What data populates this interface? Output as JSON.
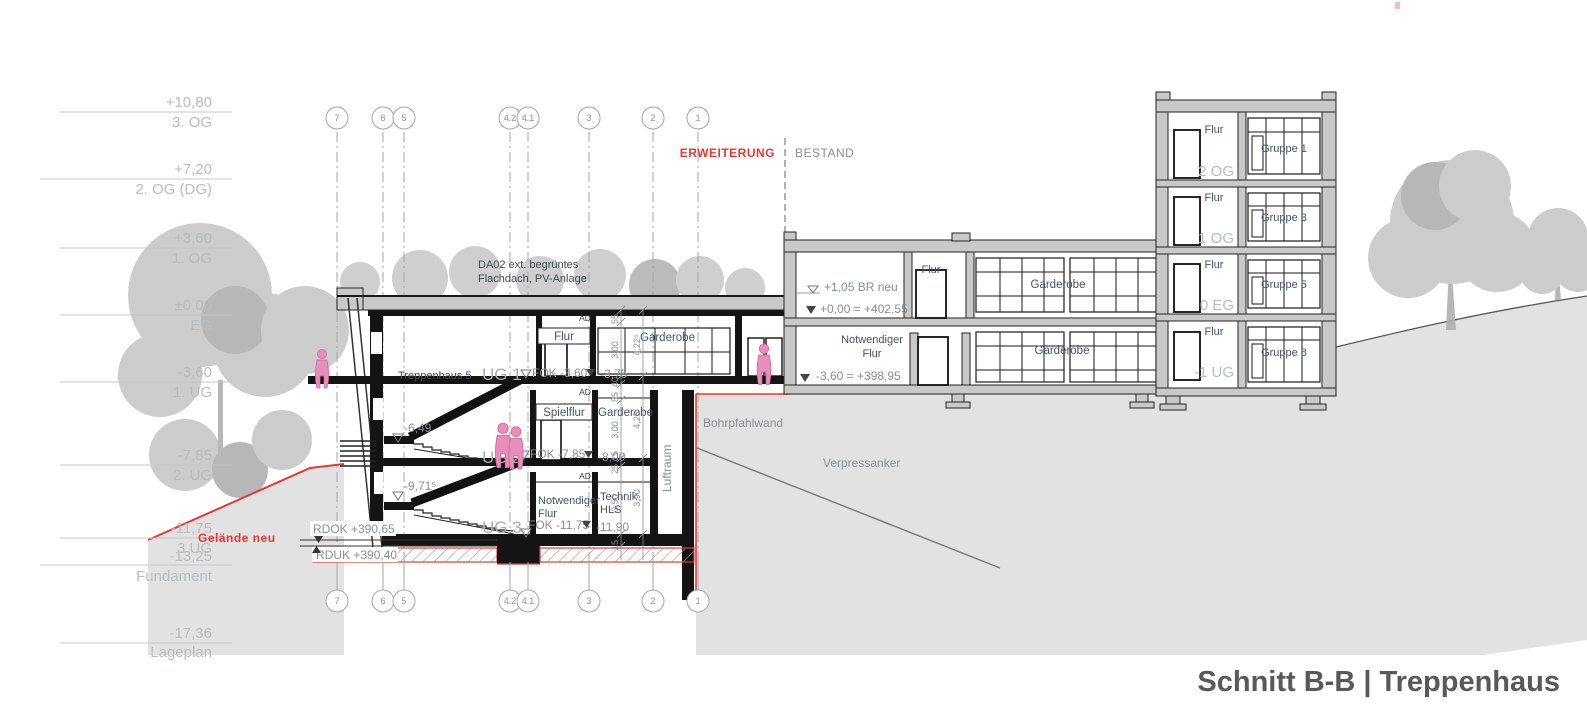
{
  "title": "Schnitt B-B | Treppenhaus",
  "zones": {
    "extension": "ERWEITERUNG",
    "existing": "BESTAND"
  },
  "elevation_scale": [
    {
      "value": "+10,80",
      "name": "3. OG"
    },
    {
      "value": "+7,20",
      "name": "2. OG (DG)"
    },
    {
      "value": "+3,60",
      "name": "1. OG"
    },
    {
      "value": "±0,00",
      "name": "EG"
    },
    {
      "value": "-3,60",
      "name": "1. UG"
    },
    {
      "value": "-7,85",
      "name": "2. UG"
    },
    {
      "value": "-11,75",
      "name": "3 UG"
    },
    {
      "value": "-13,25",
      "name": "Fundament"
    },
    {
      "value": "-17,36",
      "name": "Lageplan"
    }
  ],
  "grid_labels": [
    "7",
    "6",
    "5",
    "4.2",
    "4.1",
    "3",
    "2",
    "1"
  ],
  "extension": {
    "roof_note_l1": "DA02 ext. begrüntes",
    "roof_note_l2": "Flachdach, PV-Anlage",
    "stair_name": "Treppenhaus 5",
    "levels": [
      {
        "name": "UG 1",
        "fok": "FOK -3,60",
        "aux": "-3,75"
      },
      {
        "name": "UG 2",
        "fok": "FOK -7,85",
        "aux": "-8,00"
      },
      {
        "name": "UG 3",
        "fok": "FOK -11,75",
        "aux": "-11,90"
      }
    ],
    "mid_levels": {
      "upper": "-6,49",
      "lower": "-9,71⁵"
    },
    "rooms": {
      "ad": "AD",
      "flur": "Flur",
      "garderobe_eg": "Garderobe",
      "spielflur": "Spielflur",
      "garderobe_ug2": "Garderobe",
      "notflur_l1": "Notwendiger",
      "notflur_l2": "Flur",
      "technik_l1": "Technik",
      "technik_l2": "HLS",
      "luftraum": "Luftraum"
    },
    "dims_inner": [
      "55",
      "3,00",
      "40",
      "85",
      "3,00",
      "15",
      "25",
      "3,50",
      "15"
    ],
    "dims_outer": [
      "4,22⁵",
      "4,25",
      "3,90"
    ],
    "foundation": {
      "rdok": "RDOK +390,65",
      "rduk": "RDUK +390,40"
    },
    "ground_label": "Gelände neu",
    "bohrpfahlwand": "Bohrpfahlwand",
    "verpressanker": "Verpressanker"
  },
  "existing": {
    "levels": {
      "br": "+1,05 BR neu",
      "zero": "+0,00 = +402,55",
      "minus": "-3,60 = +398,95"
    },
    "rooms": {
      "flur": "Flur",
      "notflur_l1": "Notwendiger",
      "notflur_l2": "Flur",
      "garderobe_eg": "Garderobe",
      "garderobe_ug": "Garderobe"
    },
    "tower_floors": [
      {
        "room": "Flur",
        "group": "Gruppe 1",
        "level": "2 OG"
      },
      {
        "room": "Flur",
        "group": "Gruppe 3",
        "level": "1 OG"
      },
      {
        "room": "Flur",
        "group": "Gruppe 5",
        "level": "0 EG"
      },
      {
        "room": "Flur",
        "group": "Gruppe 8",
        "level": "-1 UG"
      }
    ]
  },
  "colors": {
    "red": "#e23b32",
    "ground": "#e2e2e2",
    "pink": "#e78fb8",
    "room_label": "#44536a"
  }
}
